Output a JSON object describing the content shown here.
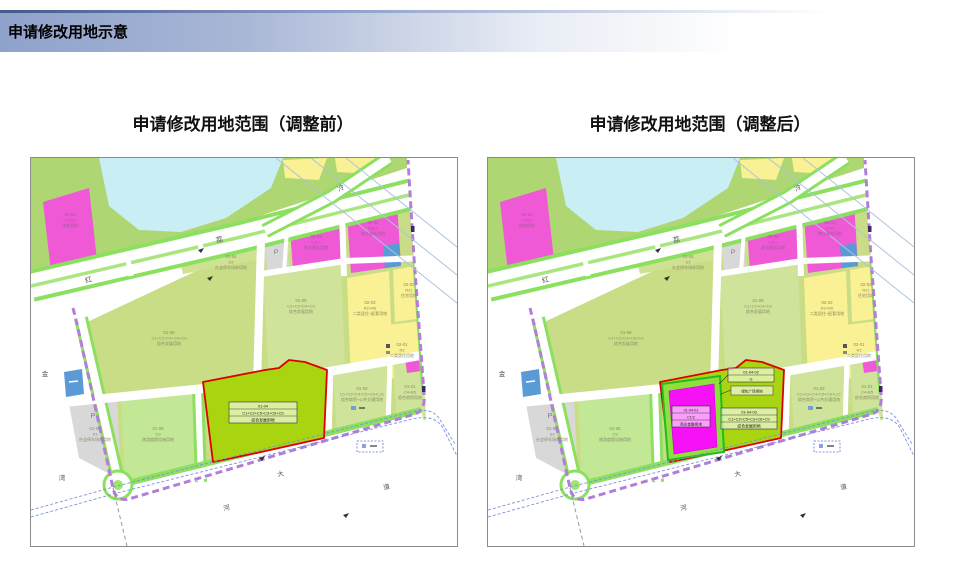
{
  "header": {
    "title": "申请修改用地示意"
  },
  "figures": {
    "before": {
      "title": "申请修改用地范围（调整前）"
    },
    "after": {
      "title": "申请修改用地范围（调整后）"
    }
  },
  "map": {
    "parking_letter": "P",
    "parcels": [
      {
        "id": "04-02",
        "lines": [
          "04-02",
          "C/IC2",
          "体育用地"
        ]
      },
      {
        "id": "03-04",
        "lines": [
          "03-04",
          "S3",
          "社会停车场库用地"
        ]
      },
      {
        "id": "03-03",
        "lines": [
          "03-03",
          "C/IC1",
          "商业服务用地"
        ]
      },
      {
        "id": "03-02",
        "lines": [
          "03-02",
          "C/IC1",
          "商业服务用地"
        ]
      },
      {
        "id": "01-08",
        "lines": [
          "01-08",
          "C1+C2+C4+C8+C9",
          "综合发展用地"
        ]
      },
      {
        "id": "01-09",
        "lines": [
          "01-09",
          "C1+C2+C4+C9",
          "综合发展用地"
        ]
      },
      {
        "id": "02-03",
        "lines": [
          "02-03",
          "R2+R6",
          "二类居住+配套用地"
        ]
      },
      {
        "id": "02-02",
        "lines": [
          "02-02",
          "R21",
          "住宅用地"
        ]
      },
      {
        "id": "02-01",
        "lines": [
          "02-01",
          "R2",
          "二类居住用地"
        ]
      },
      {
        "id": "01-06",
        "lines": [
          "01-06",
          "S3",
          "社会停车场库用地"
        ]
      },
      {
        "id": "01-05",
        "lines": [
          "01-05",
          "C9",
          "旅游度假设施用地"
        ]
      },
      {
        "id": "01-03",
        "lines": [
          "01-03",
          "C1+C2+C4+C5+C9+L21",
          "综合商贸+公共交通用地"
        ]
      },
      {
        "id": "01-01",
        "lines": [
          "01-01",
          "C4+B5",
          "综合商贸用地"
        ]
      }
    ],
    "road_labels": [
      {
        "ch": "红"
      },
      {
        "ch": "荔"
      },
      {
        "ch": "冷"
      },
      {
        "ch": "金"
      },
      {
        "ch": "湾"
      },
      {
        "ch": "大"
      },
      {
        "ch": "河"
      },
      {
        "ch": "道"
      }
    ]
  },
  "before_focus": {
    "lines": [
      "01-04",
      "C1+C2+C5+C3+C6+C9",
      "综合发展用地"
    ]
  },
  "after_focus": {
    "plot_lines": [
      "01-04-01",
      "C1/2",
      "商业金融用地"
    ],
    "main_lines": [
      "01-04-03",
      "C1+C2+C5+C3+C6+C9",
      "综合发展用地"
    ],
    "green_lines": [
      "01-04-02",
      "G"
    ],
    "green_callout": "绿化广场用地"
  },
  "colors": {
    "header_from": "#8fa2cb",
    "accent_line": "#44598c",
    "grass": "#aed672",
    "parcel": "#c9dd86",
    "parcel_light": "#cfe39a",
    "parcel_light2": "#c2e795",
    "water": "#c9eef4",
    "magenta": "#ef59d5",
    "yellow": "#f9f193",
    "gray": "#d8d8d8",
    "blue": "#5b9bd5",
    "road_green": "#8ce05f",
    "median": "#aae67f",
    "focus_fill": "#a8d50f",
    "focus_outline": "#dd0000",
    "frame_fill": "#8fdf3f",
    "frame_green": "#1fbd1f",
    "inner_magenta": "#f711f7",
    "boundary": "#b27fd8",
    "canal": "#7b8fe4",
    "power": "#abc4dd",
    "map_border": "#8a8a8a"
  }
}
